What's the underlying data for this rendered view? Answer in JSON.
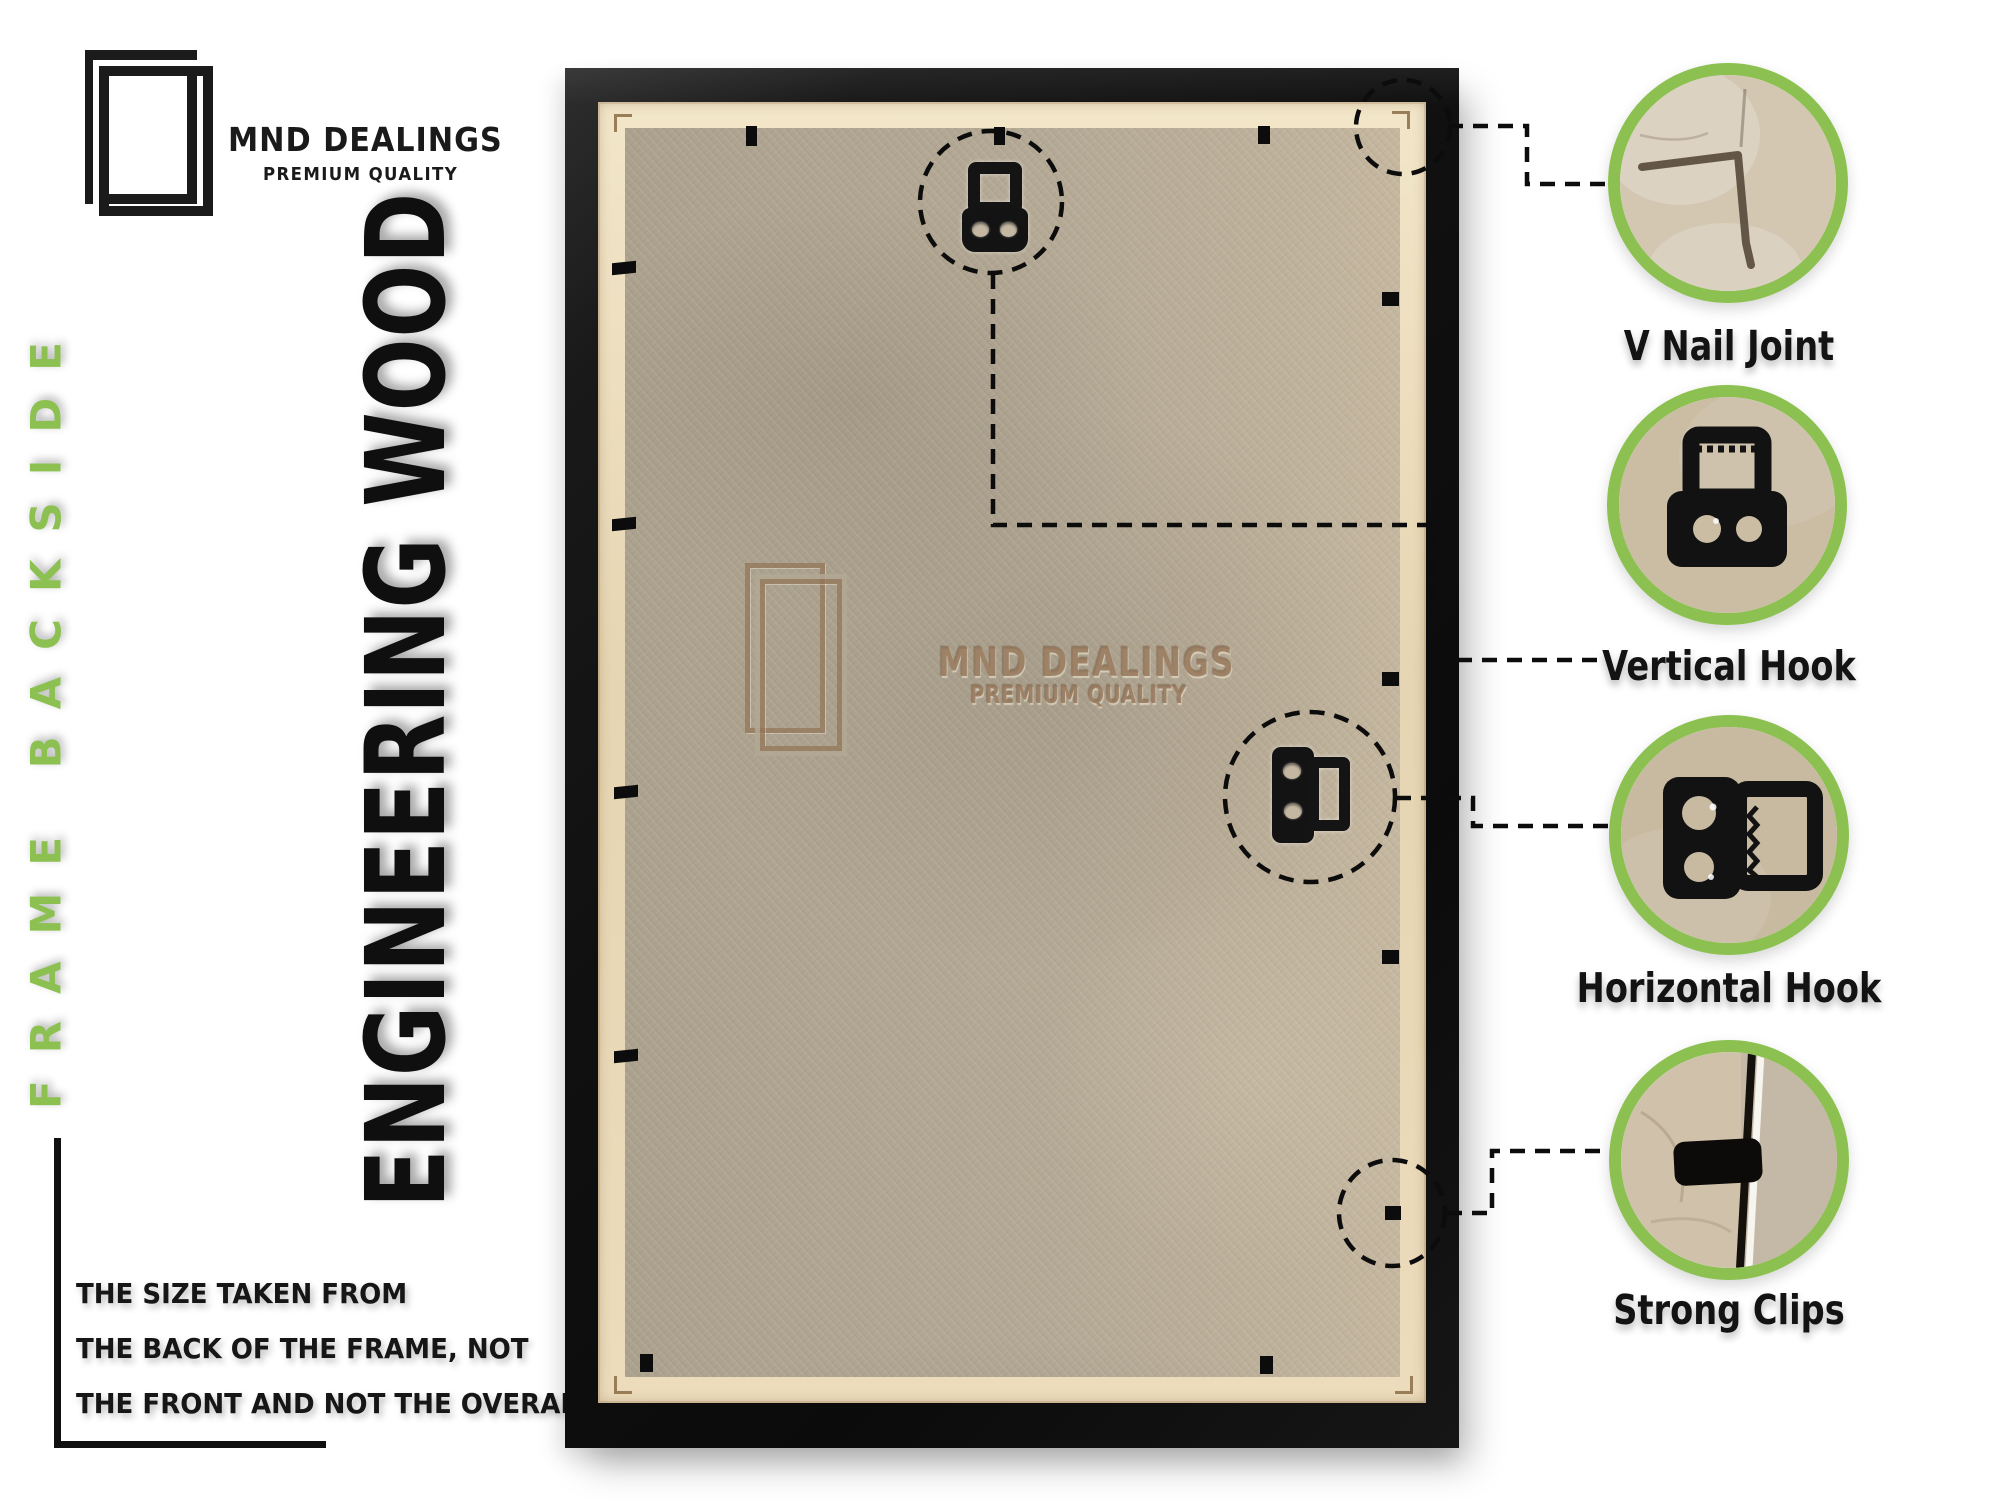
{
  "brand": {
    "name": "MND DEALINGS",
    "tagline": "PREMIUM QUALITY"
  },
  "side_label": "FRAME BACKSIDE",
  "material_label": "ENGINEERING WOOD",
  "note": {
    "lines": [
      "THE SIZE TAKEN FROM",
      "THE BACK OF THE FRAME, NOT",
      "THE FRONT AND NOT THE OVERALL SIZE."
    ]
  },
  "watermark": {
    "name": "MND DEALINGS",
    "tagline": "PREMIUM QUALITY"
  },
  "callouts": [
    {
      "id": "v-nail-joint",
      "label": "V Nail Joint"
    },
    {
      "id": "vertical-hook",
      "label": "Vertical Hook"
    },
    {
      "id": "horizontal-hook",
      "label": "Horizontal Hook"
    },
    {
      "id": "strong-clips",
      "label": "Strong Clips"
    }
  ],
  "colors": {
    "accent_green": "#8cc152",
    "frame_black": "#141414",
    "board_tan": "#b3a794",
    "liner_tan": "#e9d9ba",
    "watermark_brown": "#97785c"
  }
}
